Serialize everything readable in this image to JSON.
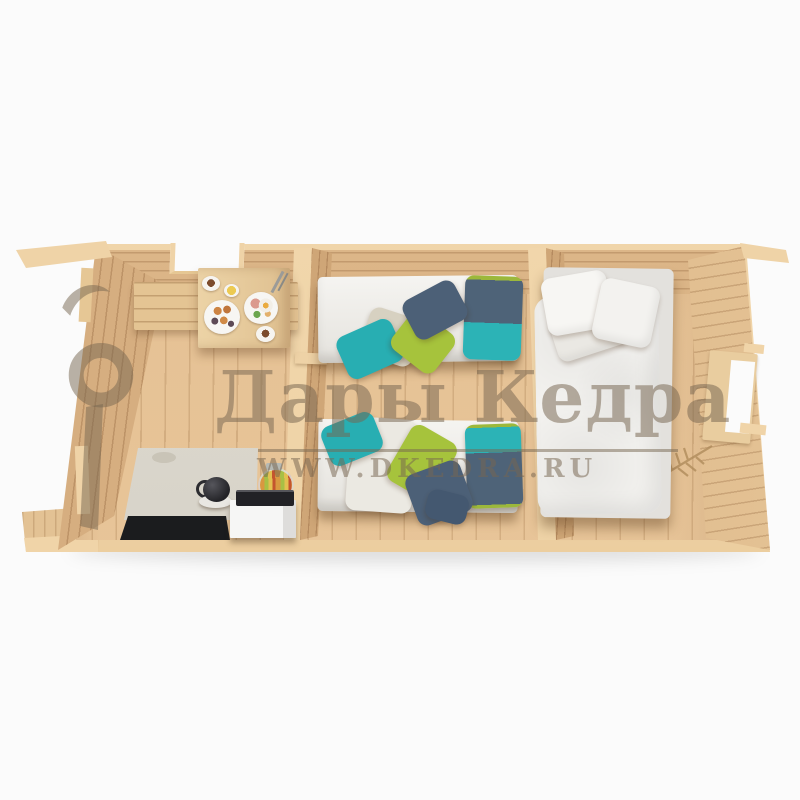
{
  "scene": {
    "description": "Top-down cutaway 3D render of a three-room wooden log cabin interior on a white background",
    "background_color": "#fbfbfb"
  },
  "watermark": {
    "brand_text": "Дары Кедра",
    "site_text": "WWW.DKEDRA.RU",
    "color": "#766550"
  },
  "palette": {
    "wood_cut_top": "#efd3a7",
    "wood_wall": "#d6ae80",
    "wood_floor": "#e6c295",
    "fabric_white": "#f4f3f0",
    "pillow_teal": "#2cb3b6",
    "pillow_navy": "#4e6378",
    "blanket_green": "#a6c33c",
    "blanket_beige": "#d7d1c1",
    "counter_grey": "#d9d5ca",
    "appliance_black": "#222226",
    "cabinet_white": "#f6f6f5"
  },
  "cabin": {
    "rooms": [
      {
        "name": "kitchen-dining",
        "furniture": [
          "wall-bench",
          "breakfast-table",
          "kitchen-counter",
          "sink",
          "kettle",
          "fruit-jar",
          "cabinet-with-cooktop",
          "floor-mat"
        ],
        "table_items": [
          "coffee-cup",
          "lemon-dish",
          "plate-with-buns",
          "plate-with-egg-and-ham",
          "second-cup",
          "cutlery"
        ]
      },
      {
        "name": "kids-bedroom",
        "furniture": [
          "single-bed-top",
          "single-bed-bottom"
        ],
        "bedding": [
          "teal-navy-pillows",
          "green-teal-navy-beige-blankets"
        ]
      },
      {
        "name": "master-bedroom",
        "furniture": [
          "double-bed-with-white-duvet-and-pillows"
        ]
      }
    ],
    "features": [
      "kitchen-window-opening-top-wall",
      "bedroom-window-opening-right-wall",
      "carved-branch-ornament",
      "porch-overhang-and-rails",
      "open-cutaway-front"
    ]
  }
}
